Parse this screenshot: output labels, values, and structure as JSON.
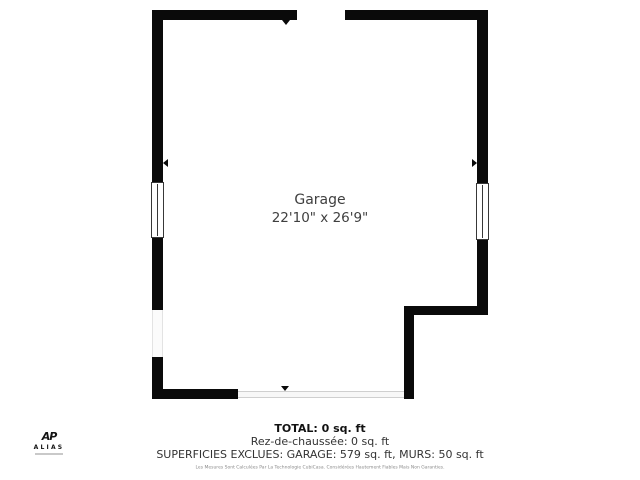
{
  "colors": {
    "wall": "#0a0a0a",
    "label": "#3f3f3f",
    "opening": "#cfcfcf",
    "muted": "#8a8a8a"
  },
  "plan": {
    "room_label": "Garage",
    "room_dimensions": "22'10\" x 26'9\""
  },
  "summary": {
    "total": "TOTAL: 0 sq. ft",
    "floor_line": "Rez-de-chaussée: 0 sq. ft",
    "exclusions": "SUPERFICIES EXCLUES: GARAGE: 579 sq. ft, MURS: 50 sq. ft",
    "disclaimer": "Les Mesures Sont Calculées Par La Technologie CubiCasa. Considérées Hautement Fiables Mais Non Garanties."
  },
  "logo": {
    "monogram": "AP",
    "brand": "ALIAS"
  }
}
